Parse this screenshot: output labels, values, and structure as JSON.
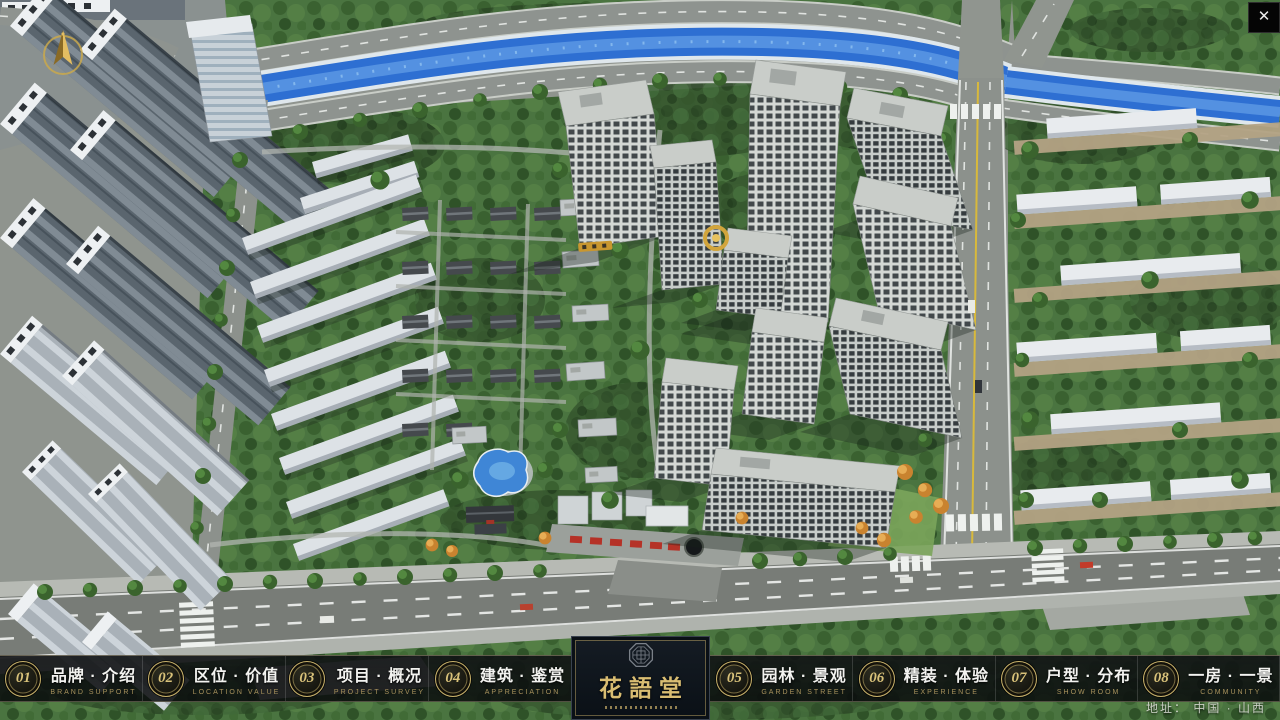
{
  "window": {
    "close_glyph": "✕"
  },
  "nav": {
    "items": [
      {
        "num": "01",
        "zh": "品牌 · 介绍",
        "en": "BRAND SUPPORT"
      },
      {
        "num": "02",
        "zh": "区位 · 价值",
        "en": "LOCATION VALUE"
      },
      {
        "num": "03",
        "zh": "项目 · 概况",
        "en": "PROJECT SURVEY"
      },
      {
        "num": "04",
        "zh": "建筑 · 鉴赏",
        "en": "APPRECIATION"
      },
      {
        "num": "05",
        "zh": "园林 · 景观",
        "en": "GARDEN STREET"
      },
      {
        "num": "06",
        "zh": "精装 · 体验",
        "en": "EXPERIENCE"
      },
      {
        "num": "07",
        "zh": "户型 · 分布",
        "en": "SHOW ROOM"
      },
      {
        "num": "08",
        "zh": "一房 · 一景",
        "en": "COMMUNITY"
      }
    ]
  },
  "logo": {
    "title": "花語堂"
  },
  "footer": {
    "address": "地址： 中国 · 山西"
  },
  "icons": {
    "compass": "north-compass",
    "close": "close-x",
    "emblem": "octagon-seal"
  },
  "colors": {
    "accent_gold": "#c9b26a",
    "bar_bg": "#0b0d0e",
    "river_blue": "#2e6fd2",
    "foliage_green": "#4a7440",
    "road_gray": "#8e938f",
    "logo_gold": "#d9bd72"
  }
}
